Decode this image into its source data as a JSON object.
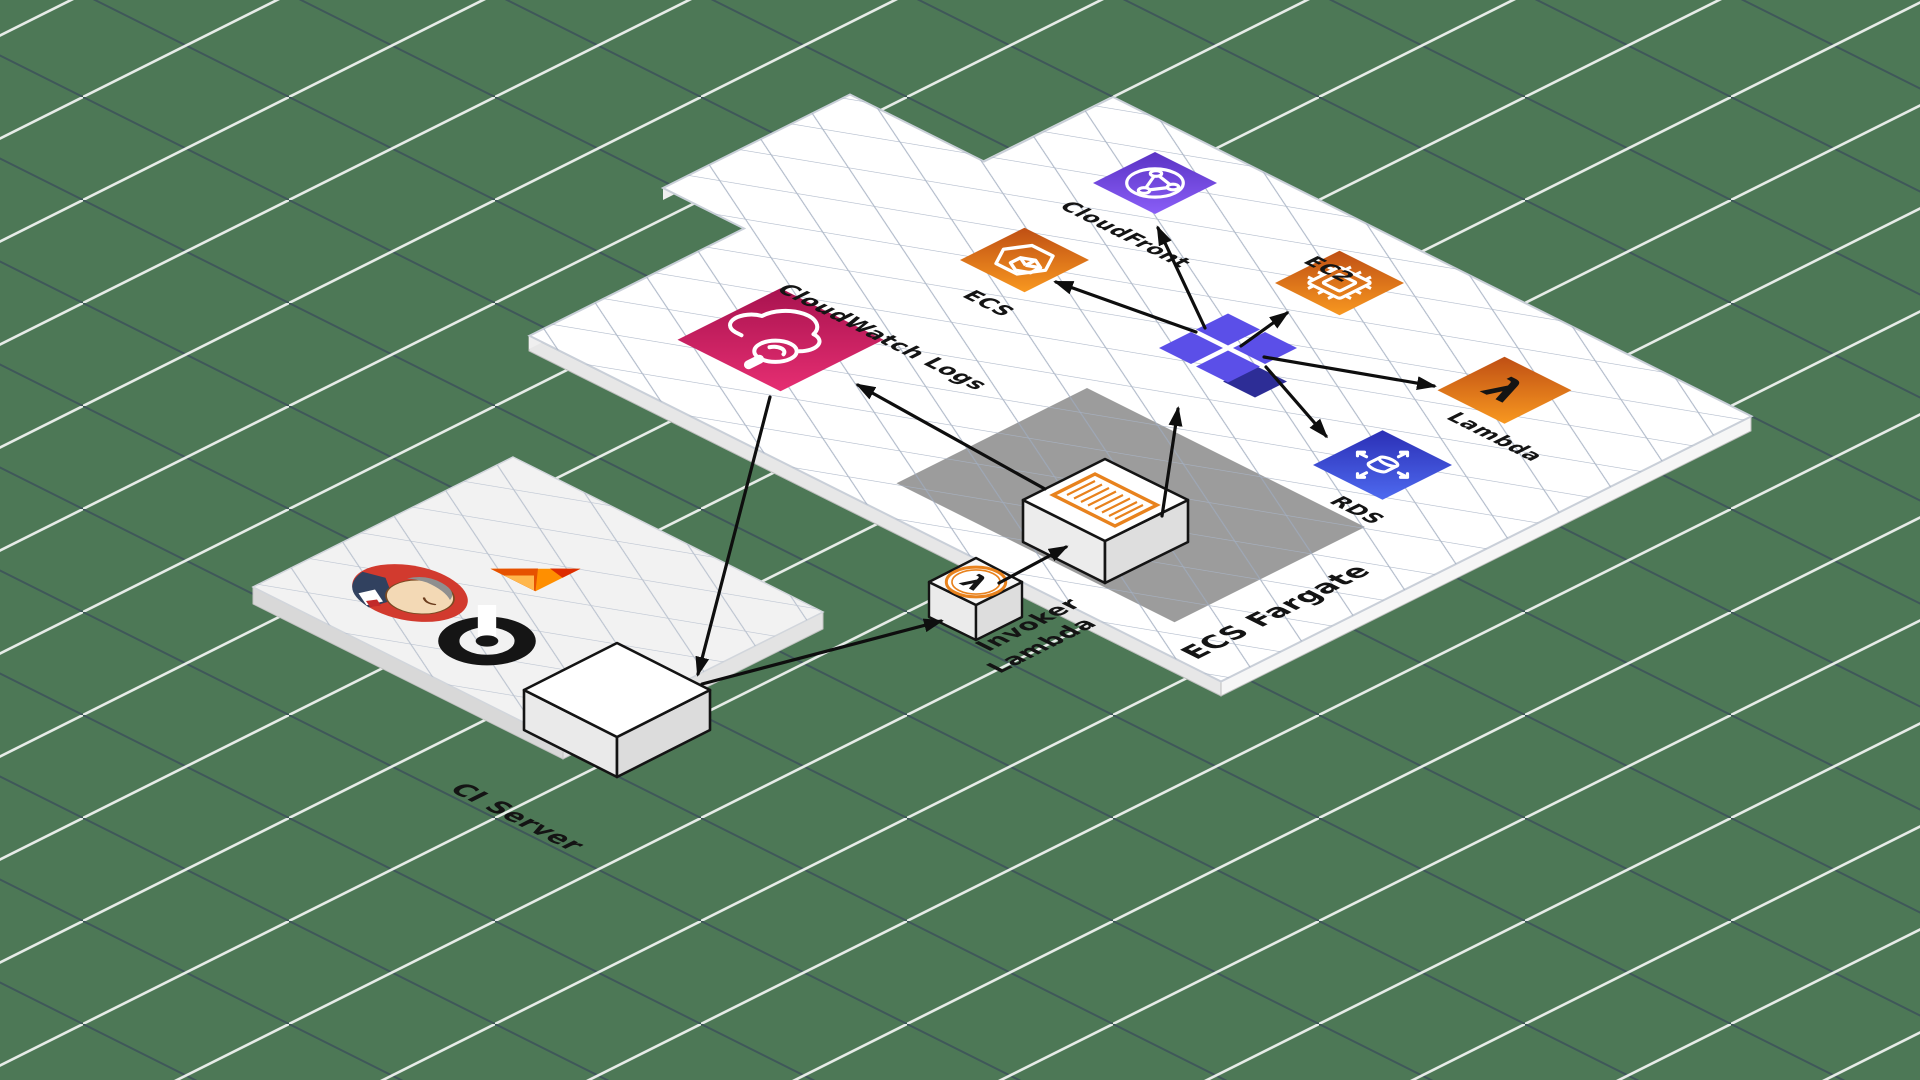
{
  "scene": {
    "kind": "isometric-aws-architecture-diagram",
    "background_color": "#4d7856",
    "platform_color": "#ffffff",
    "fargate_zone_color": "#9c9c9c",
    "ci_platform_color": "#f2f2f2",
    "arrow_color": "#111111"
  },
  "labels": {
    "cloudfront": "CloudFront",
    "ecs": "ECS",
    "ec2": "EC2",
    "lambda": "Lambda",
    "rds": "RDS",
    "cloudwatch_logs": "CloudWatch Logs",
    "invoker_line1": "Invoker",
    "invoker_line2": "Lambda",
    "ecs_fargate": "ECS Fargate",
    "ci_server": "CI Server"
  },
  "glyphs": {
    "lambda_symbol": "λ"
  },
  "nodes": [
    {
      "id": "cloudfront",
      "label": "CloudFront",
      "icon": "globe-network",
      "color": "#7a4fe0"
    },
    {
      "id": "ecs",
      "label": "ECS",
      "icon": "hexagon-container",
      "color": "#e8821d"
    },
    {
      "id": "ec2",
      "label": "EC2",
      "icon": "chip",
      "color": "#e8821d"
    },
    {
      "id": "lambda",
      "label": "Lambda",
      "icon": "lambda",
      "color": "#e8821d"
    },
    {
      "id": "rds",
      "label": "RDS",
      "icon": "database-arrows",
      "color": "#3f51d6"
    },
    {
      "id": "cloudwatch-logs",
      "label": "CloudWatch Logs",
      "icon": "cloud-magnifier",
      "color": "#d12465"
    },
    {
      "id": "junction",
      "label": "",
      "icon": "purple-diamond-cluster",
      "color": "#5b4fe8"
    },
    {
      "id": "ecs-task",
      "label": "",
      "icon": "log-document-box",
      "color": "#ffffff"
    },
    {
      "id": "invoker-lambda",
      "label": "Invoker Lambda",
      "icon": "lambda-cube",
      "color": "#ffffff"
    },
    {
      "id": "ci-box",
      "label": "",
      "icon": "plain-box",
      "color": "#ffffff"
    },
    {
      "id": "jenkins",
      "label": "",
      "icon": "jenkins-butler-logo",
      "color": "#d23a2e"
    },
    {
      "id": "flame-logo",
      "label": "",
      "icon": "flame-logo",
      "color": "#f57c00"
    },
    {
      "id": "b-logo",
      "label": "",
      "icon": "black-b-circle-logo",
      "color": "#151515"
    }
  ],
  "zones": [
    {
      "id": "ecs-fargate",
      "label": "ECS Fargate"
    },
    {
      "id": "ci-server",
      "label": "CI Server"
    }
  ],
  "edges": [
    {
      "from": "cloudwatch-logs",
      "to": "ci-box"
    },
    {
      "from": "ci-box",
      "to": "invoker-lambda"
    },
    {
      "from": "invoker-lambda",
      "to": "ecs-task"
    },
    {
      "from": "ecs-task",
      "to": "cloudwatch-logs"
    },
    {
      "from": "ecs-task",
      "to": "junction"
    },
    {
      "from": "junction",
      "to": "ecs"
    },
    {
      "from": "junction",
      "to": "cloudfront"
    },
    {
      "from": "junction",
      "to": "ec2"
    },
    {
      "from": "junction",
      "to": "lambda"
    },
    {
      "from": "junction",
      "to": "rds"
    }
  ]
}
